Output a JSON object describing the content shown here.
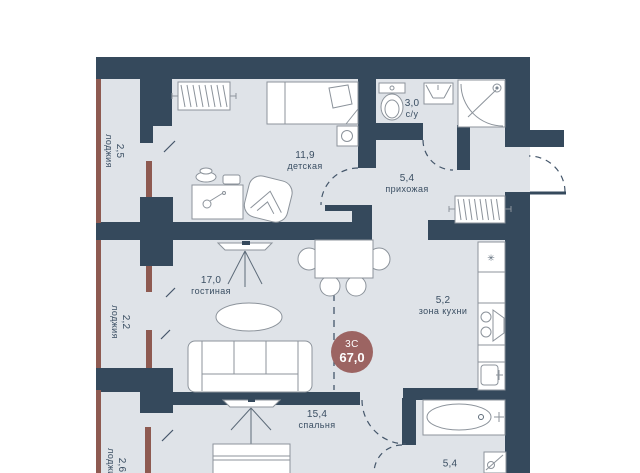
{
  "plan": {
    "badge": {
      "type_label": "3С",
      "total_area": "67,0"
    },
    "rooms": [
      {
        "key": "detskaya",
        "area": "11,9",
        "name": "детская"
      },
      {
        "key": "su1",
        "area": "3,0",
        "name": "с/у"
      },
      {
        "key": "prihozhaya",
        "area": "5,4",
        "name": "прихожая"
      },
      {
        "key": "gostinaya",
        "area": "17,0",
        "name": "гостиная"
      },
      {
        "key": "kitchen-zone",
        "area": "5,2",
        "name": "зона кухни"
      },
      {
        "key": "spalnya",
        "area": "15,4",
        "name": "спальня"
      },
      {
        "key": "su2",
        "area": "5,4",
        "name": ""
      },
      {
        "key": "loggia-top",
        "area": "2,5",
        "name": "лоджия"
      },
      {
        "key": "loggia-mid",
        "area": "2,2",
        "name": "лоджия"
      },
      {
        "key": "loggia-bottom",
        "area": "2,6",
        "name": "лоджия"
      }
    ],
    "colors": {
      "wall": "#35495c",
      "floor": "#dfe3e8",
      "accent": "#8e5a51",
      "badge": "#9c6462",
      "line": "#8c939b",
      "text": "#3a4e62"
    },
    "icons": {
      "fridge_mark": "✳"
    }
  }
}
